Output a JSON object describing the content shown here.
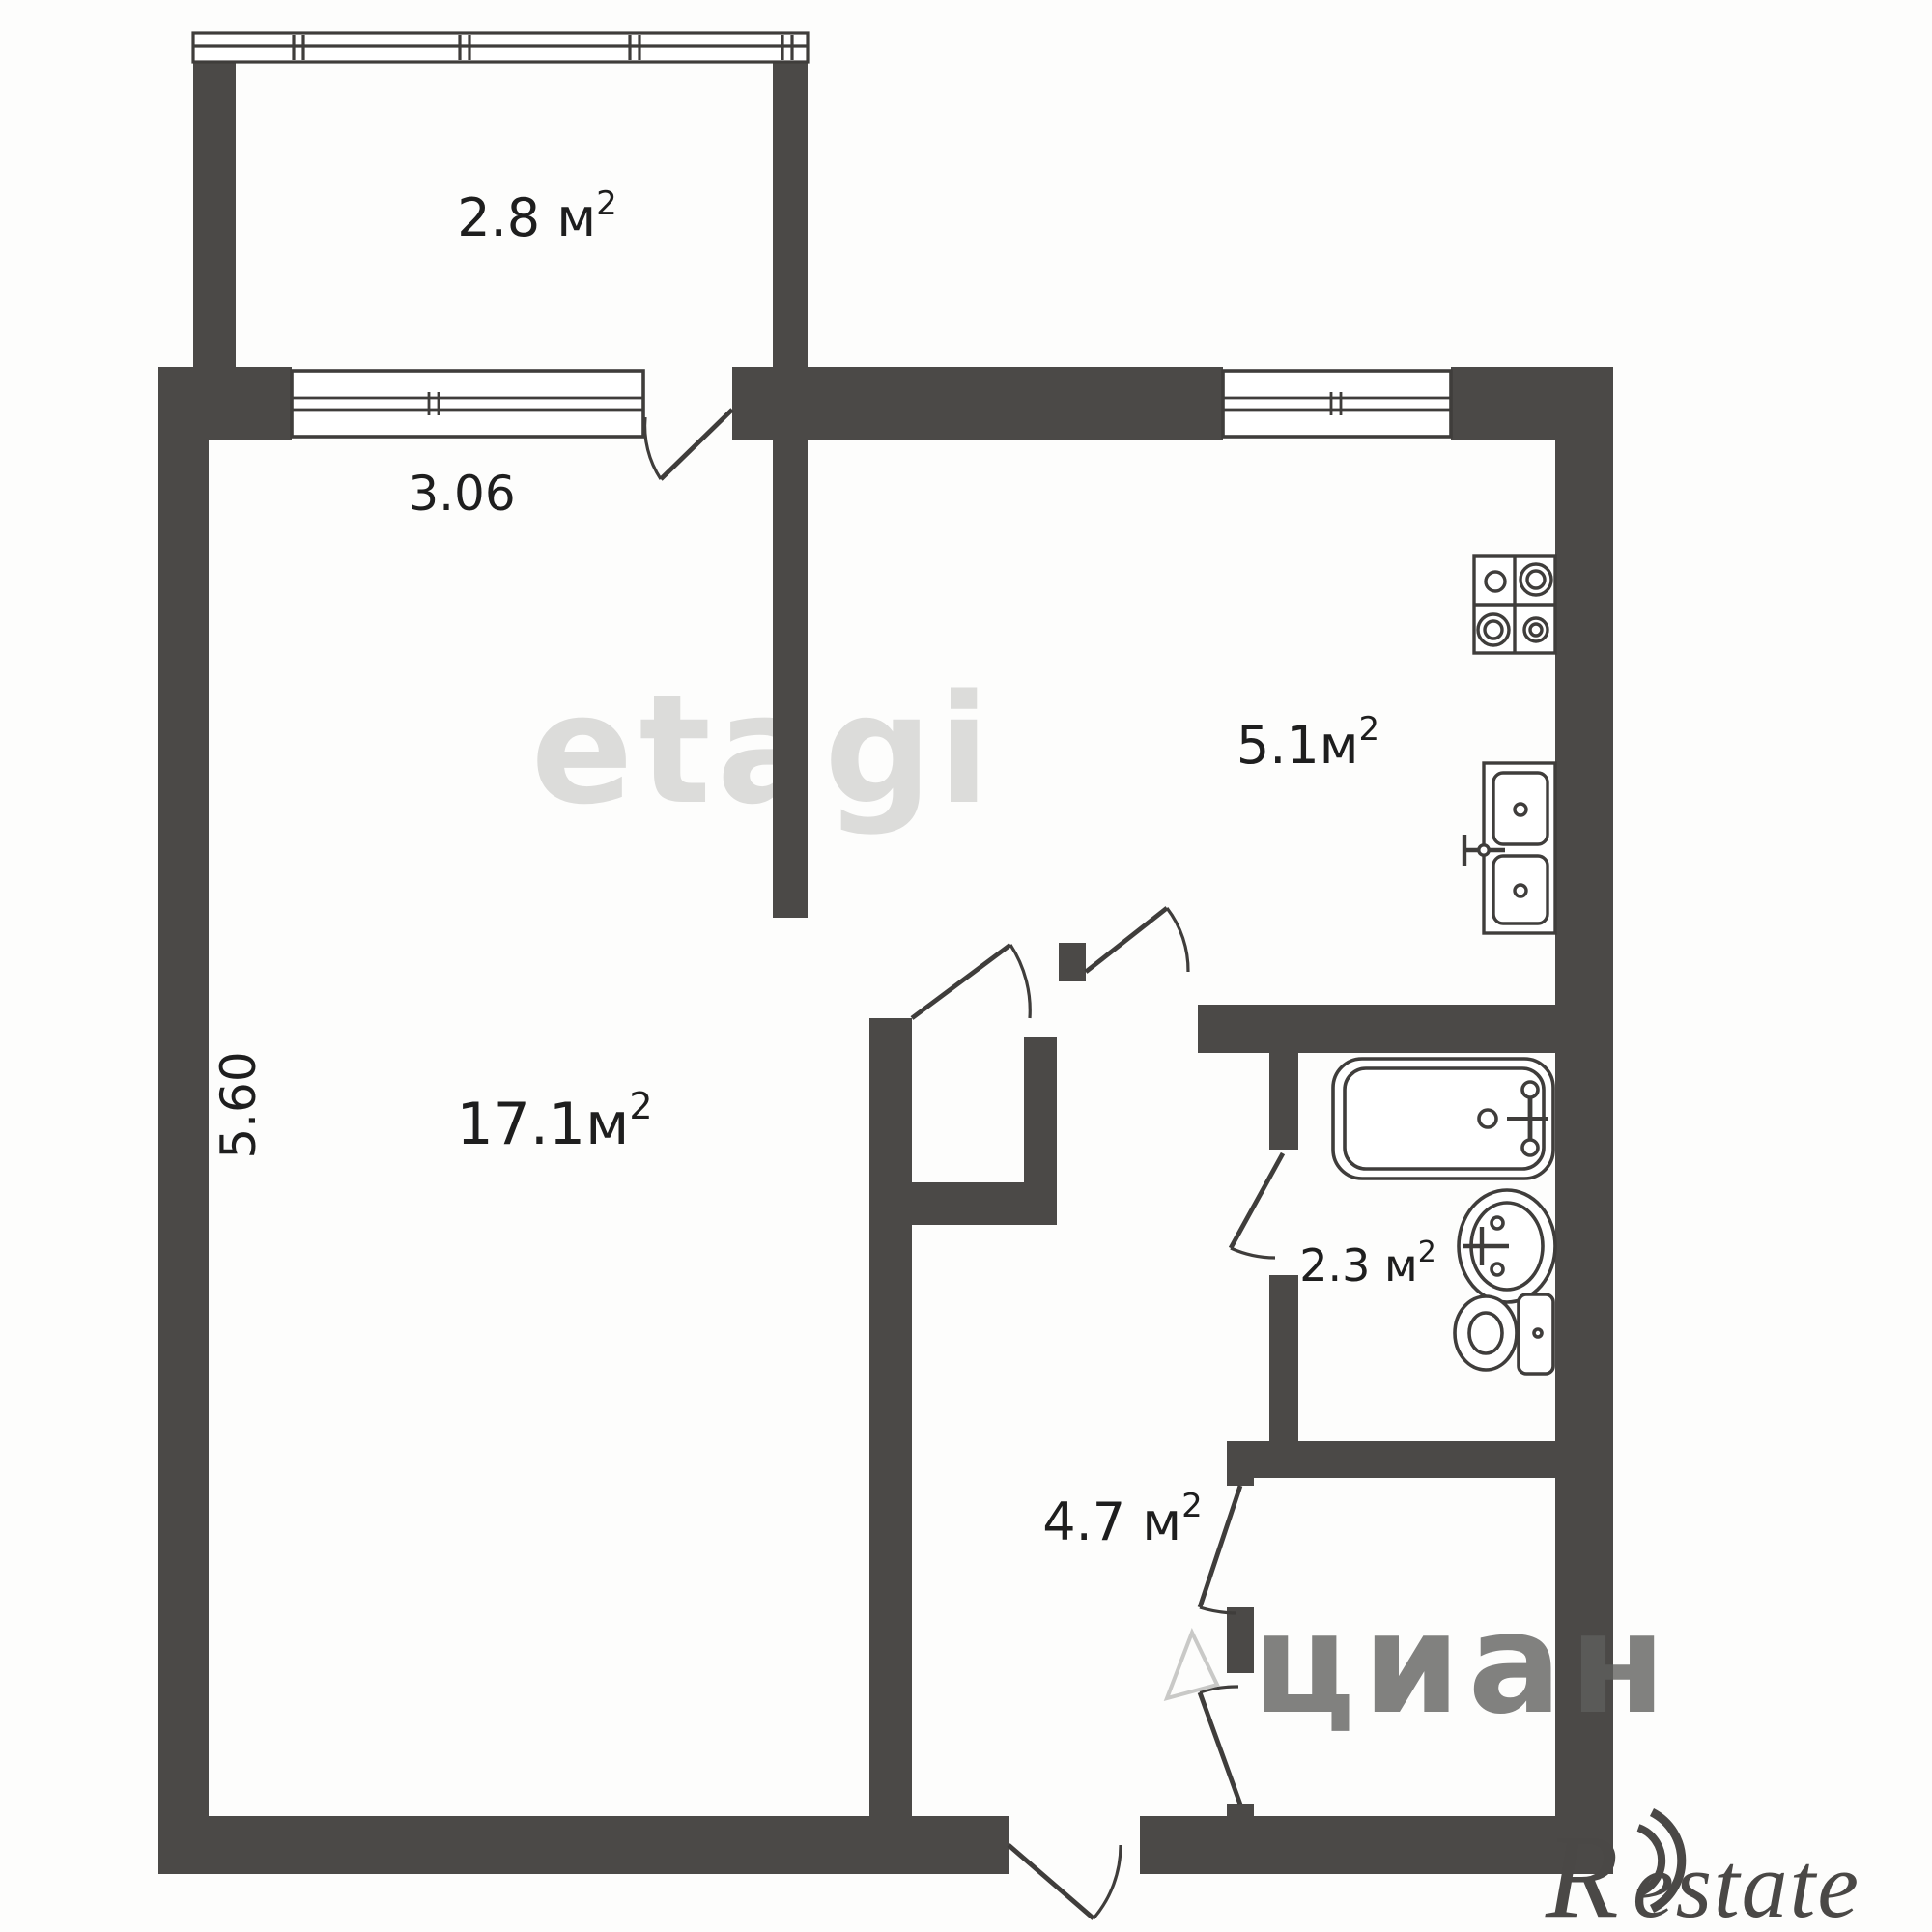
{
  "plan": {
    "type": "apartment-floor-plan",
    "rooms": {
      "balcony": {
        "area_main": "2.8 м",
        "area_sup": "2"
      },
      "living": {
        "area_main": "17.1м",
        "area_sup": "2"
      },
      "kitchen": {
        "area_main": "5.1м",
        "area_sup": "2"
      },
      "bathroom": {
        "area_main": "2.3 м",
        "area_sup": "2"
      },
      "hallway": {
        "area_main": "4.7 м",
        "area_sup": "2"
      }
    },
    "dimensions": {
      "window_width": "3.06",
      "room_height": "5.60"
    },
    "fixtures": [
      "stove-icon",
      "kitchen-sink-icon",
      "bathtub-icon",
      "washbasin-icon",
      "toilet-icon"
    ],
    "watermarks": {
      "center": "etagi",
      "bottom_right": "циан",
      "brand_r": "R",
      "brand_rest": "estate"
    },
    "colors": {
      "wall": "#4b4947",
      "line": "#3f3d3b",
      "label": "#1e1e1e",
      "watermark_light": "#dcdcda",
      "watermark_mid": "#6f6f6d",
      "brand": "#4a4846",
      "background": "#fdfdfc"
    }
  }
}
